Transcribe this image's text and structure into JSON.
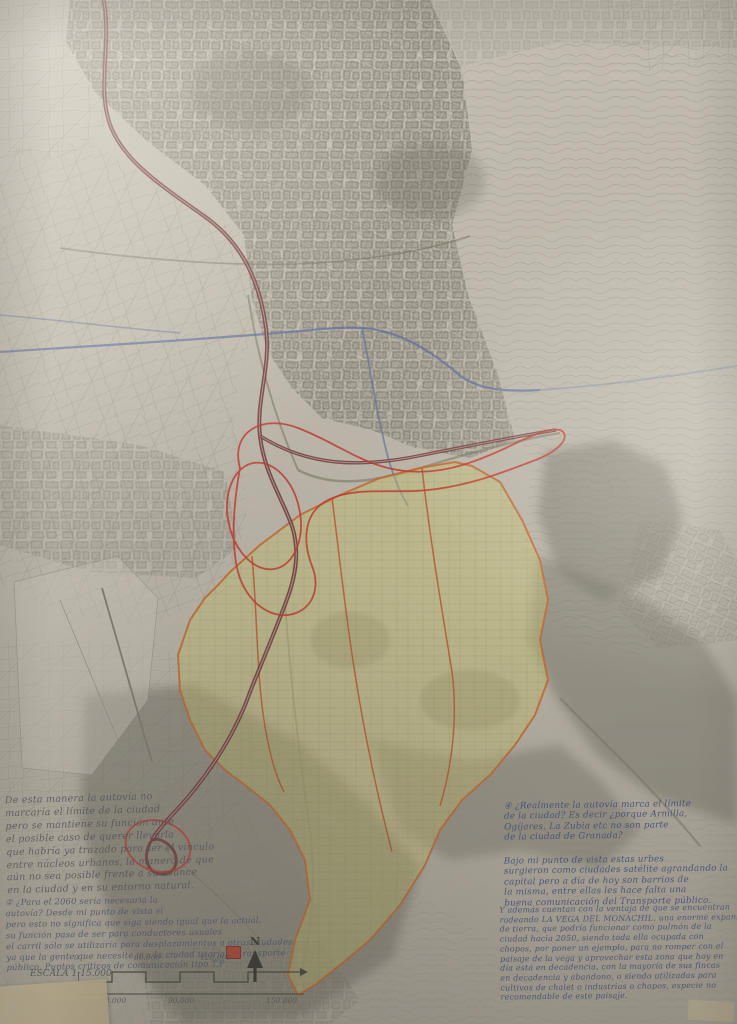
{
  "meta": {
    "description": "Photographed hand-drawn urbanism map of Granada and its Vega, traced in grey ink with yellow highlighted Vega zone, red pen annotations and handwritten Spanish notes",
    "language": "es"
  },
  "colors": {
    "paper": "#bdb7ab",
    "ink": "#6f6c60",
    "contour": "#8e8b7e",
    "motorway": "#713437",
    "river": "#5f6d9c",
    "vega_fill": "#c6c06e",
    "vega_line": "#c2672f",
    "vega_inner": "#b8502d",
    "red_pen": "#c23a30",
    "dark_mass": "#6e6c60",
    "pencil": "#4f4f58",
    "pencil_blue": "#4a5070",
    "pen_blue": "#3d4b7d",
    "legend": "#b5432e",
    "tape": "#cec09c"
  },
  "notes_left": {
    "para1_lines": [
      "De esta manera la autovía no",
      "marcaría el límite de la ciudad",
      "pero se mantiene su función ante",
      "el posible caso de querer llevarla",
      "que habría ya trazado para ser el vínculo",
      "entre núcleos urbanos, la manera de que",
      "aún no sea posible frente a su avance",
      "en la ciudad y en su entorno natural."
    ],
    "para2_lines": [
      "② ¿Para el 2060 sería necesaria la",
      "autovía? Desde mi punto de vista sí",
      "pero esto no significa que siga siendo igual que la actual,",
      "su función pasa de ser para conductores usuales",
      "el carril sólo se utilizaría para desplazamientos a otras ciudades",
      "ya que la gente que necesite ir a la ciudad usaría el transporte",
      "público. Puntos críticos de comunicación tipo T.P"
    ],
    "legend_label": "T.P"
  },
  "notes_right": {
    "para1_lines": [
      "④ ¿Realmente la autovía marca el límite",
      "de la ciudad? Es decir ¿porque Armilla,",
      "Ogíjares, La Zubia etc no son parte",
      "de la ciudad de Granada?"
    ],
    "para2_lines": [
      "Bajo mi punto de vista estas urbes",
      "surgieron como ciudades satélite agrandando la",
      "capital pero a día de hoy son barrios de",
      "la misma, entre ellas les hace falta una",
      "buena comunicación del Transporte público."
    ],
    "para3_lines": [
      "Y además cuentan con la ventaja de que se encuentran",
      "rodeando LA VEGA DEL MONACHIL, una enorme expansión",
      "de tierra, que podría funcionar como pulmón de la",
      "ciudad hacia 2050, siendo toda ella ocupada con",
      "chopos, por poner un ejemplo, para no romper con el",
      "paisaje de la vega y aprovechar esta zona que hoy en",
      "día está en decadencia, con la mayoría de sus fincas",
      "en decadencia y abandono, o siendo utilizadas para",
      "cultivos de chalet o industrias o chopos, especie no",
      "recomendable de este paisaje."
    ]
  },
  "scale_bar": {
    "label": "ESCALA 1:15.000",
    "ticks_top": [
      "0",
      "60.000",
      "120.000"
    ],
    "ticks_bottom": [
      "30.000",
      "90.000",
      "150.000"
    ]
  },
  "compass": {
    "label": "N"
  }
}
